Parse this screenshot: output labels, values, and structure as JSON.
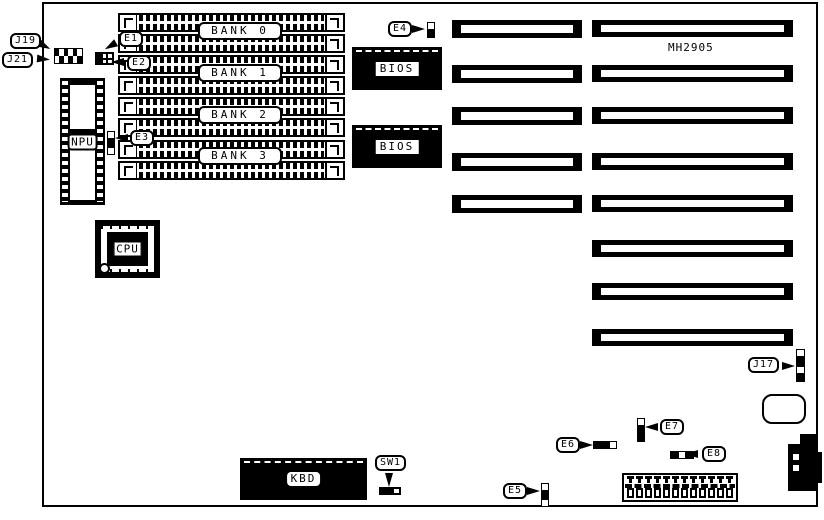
{
  "diagram": {
    "title": "MH2905",
    "banks": [
      "BANK 0",
      "BANK 1",
      "BANK 2",
      "BANK 3"
    ],
    "chips": {
      "npu": "NPU",
      "cpu": "CPU",
      "bios": "BIOS",
      "kbd": "KBD"
    },
    "callouts": {
      "j19": "J19",
      "j21": "J21",
      "e1": "E1",
      "e2": "E2",
      "e3": "E3",
      "e4": "E4",
      "e5": "E5",
      "e6": "E6",
      "e7": "E7",
      "e8": "E8",
      "j17": "J17",
      "sw1": "SW1"
    }
  }
}
